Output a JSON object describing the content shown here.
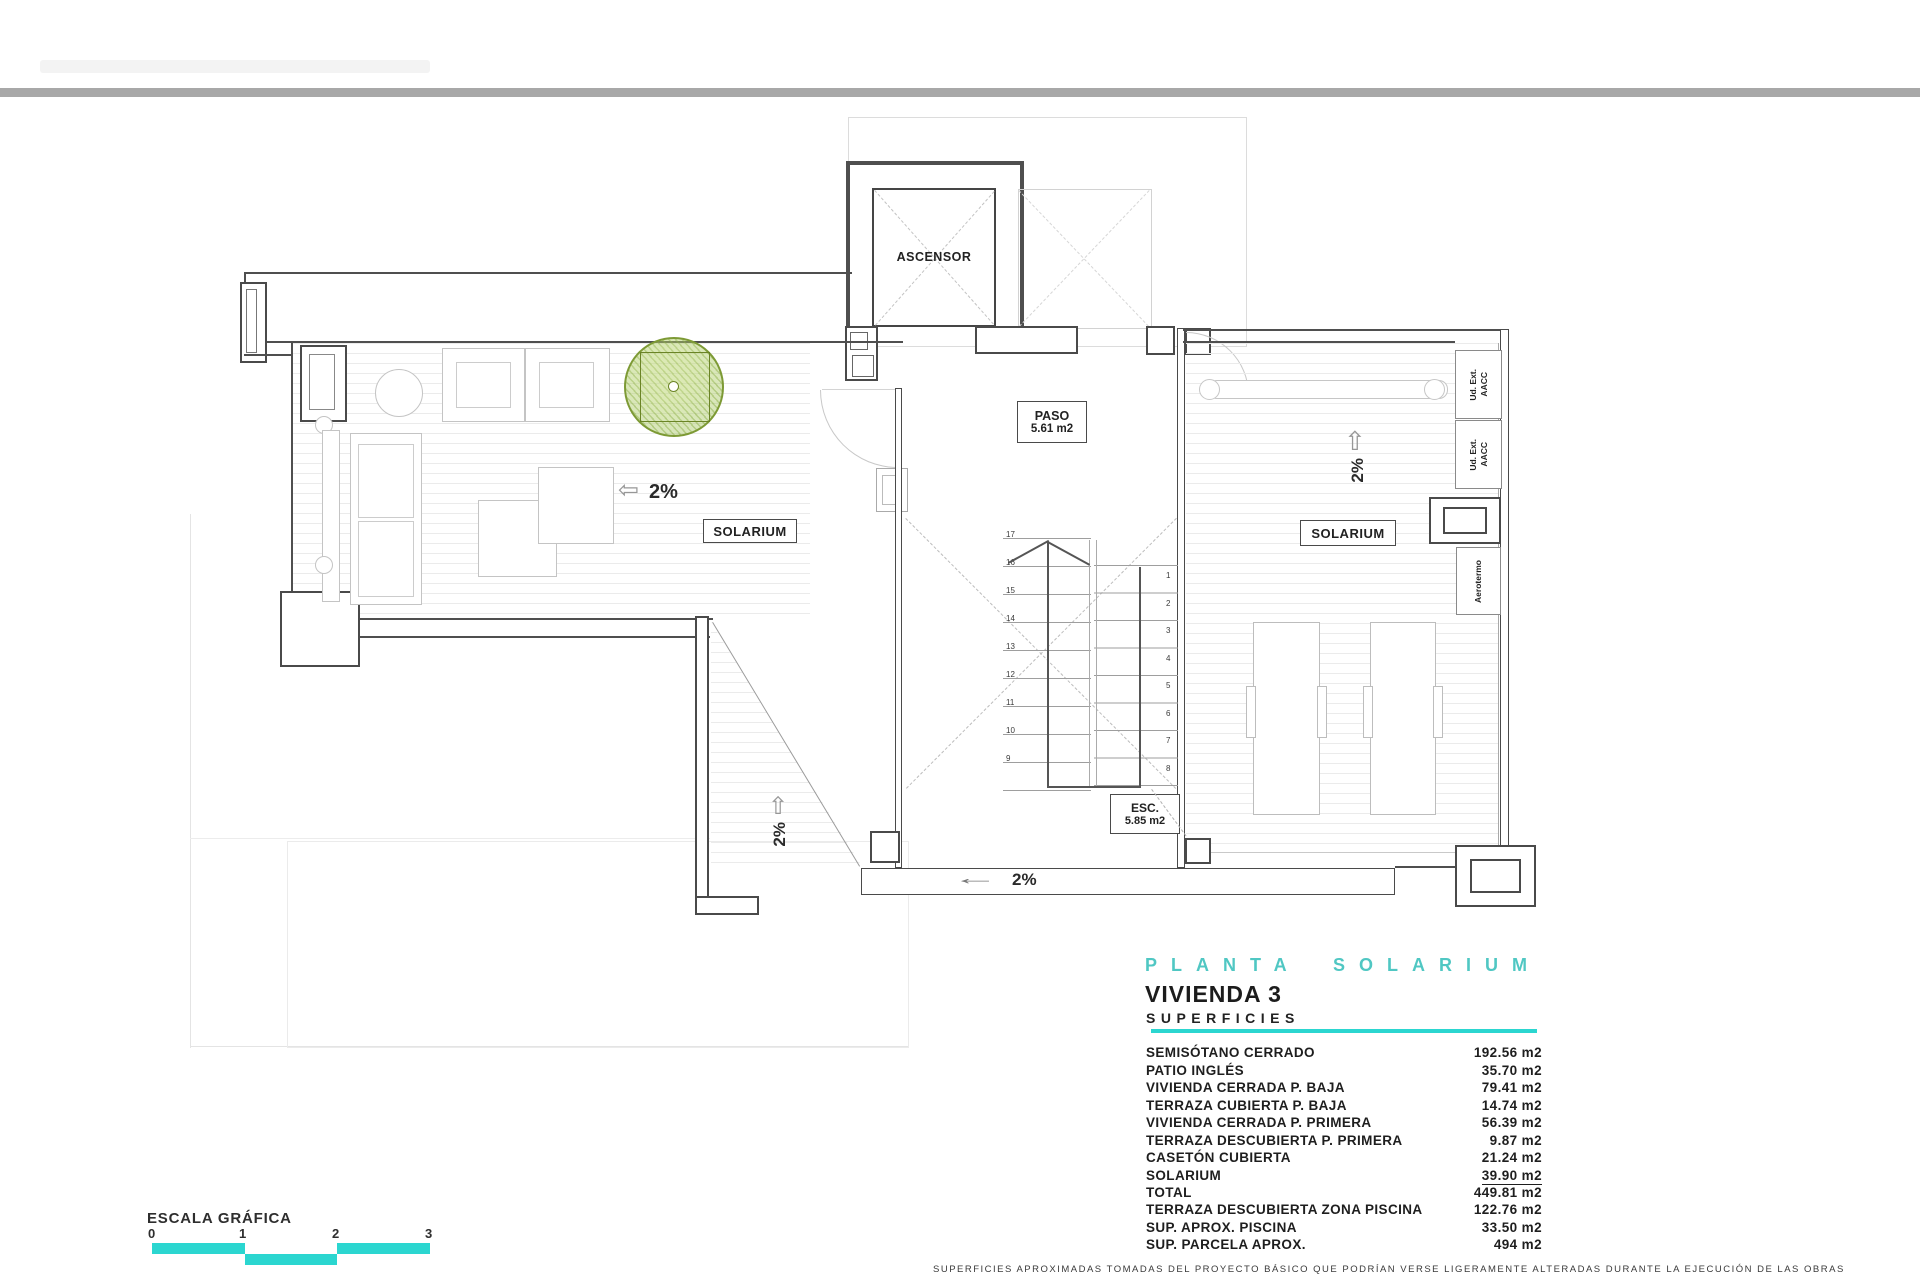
{
  "colors": {
    "teal_heading": "#50c7c3",
    "cyan_bar": "#2bd6d0",
    "line_dark": "#4f4f4f",
    "line_light": "#c6c6c6",
    "tree_green": "#7d9a35",
    "top_bar_gray": "#a8a8a8"
  },
  "plan": {
    "ascensor_label": "ASCENSOR",
    "paso": {
      "title": "PASO",
      "area": "5.61 m2"
    },
    "esc": {
      "title": "ESC.",
      "area": "5.85 m2"
    },
    "solarium_left_label": "SOLARIUM",
    "solarium_right_label": "SOLARIUM",
    "ud_ext": {
      "line1": "Ud. Ext.",
      "line2": "AACC"
    },
    "aerotermo_label": "Aerotermo",
    "slope_left": "2%",
    "slope_right": "2%",
    "slope_lower": "2%",
    "slope_bottom": "2%",
    "icons": {
      "up_arrow": "⇧",
      "left_arrow": "⇦",
      "long_left_arrow": "←"
    },
    "stairs": {
      "left_numbers": [
        "17",
        "16",
        "15",
        "14",
        "13",
        "12",
        "11",
        "10",
        "9"
      ],
      "right_numbers": [
        "1",
        "2",
        "3",
        "4",
        "5",
        "6",
        "7",
        "8"
      ]
    }
  },
  "titleblock": {
    "plan_title": "PLANTA SOLARIUM",
    "dwelling": "VIVIENDA 3",
    "surfaces_heading": "SUPERFICIES",
    "rows": [
      {
        "label": "SEMISÓTANO CERRADO",
        "value": "192.56 m2"
      },
      {
        "label": "PATIO INGLÉS",
        "value": "35.70 m2"
      },
      {
        "label": "VIVIENDA CERRADA P. BAJA",
        "value": "79.41 m2"
      },
      {
        "label": "TERRAZA CUBIERTA P. BAJA",
        "value": "14.74 m2"
      },
      {
        "label": "VIVIENDA CERRADA P. PRIMERA",
        "value": "56.39 m2"
      },
      {
        "label": "TERRAZA DESCUBIERTA P. PRIMERA",
        "value": "9.87 m2"
      },
      {
        "label": "CASETÓN CUBIERTA",
        "value": "21.24 m2"
      },
      {
        "label": "SOLARIUM",
        "value": "39.90 m2",
        "underline": true
      },
      {
        "label": "TOTAL",
        "value": "449.81 m2"
      }
    ],
    "rows_secondary": [
      {
        "label": "TERRAZA DESCUBIERTA  ZONA PISCINA",
        "value": "122.76 m2"
      },
      {
        "label": "SUP.  APROX.  PISCINA",
        "value": "33.50 m2"
      },
      {
        "label": "SUP. PARCELA APROX.",
        "value": "494 m2"
      }
    ]
  },
  "scalebar": {
    "label": "ESCALA GRÁFICA",
    "ticks": [
      "0",
      "1",
      "2",
      "3"
    ]
  },
  "disclaimer": "SUPERFICIES APROXIMADAS TOMADAS DEL PROYECTO BÁSICO QUE PODRÍAN VERSE LIGERAMENTE ALTERADAS DURANTE LA EJECUCIÓN DE LAS OBRAS"
}
